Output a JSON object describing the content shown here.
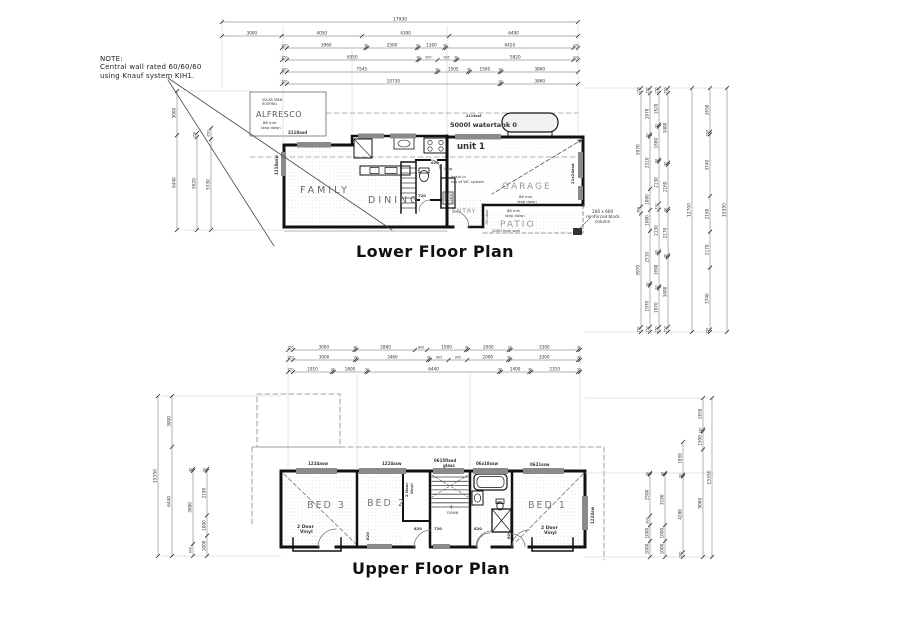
{
  "note": {
    "line1": "NOTE:",
    "line2": "Central wall rated 60/60/60",
    "line3": "using Knauf system KIH1."
  },
  "lower_plan": {
    "title": "Lower Floor Plan"
  },
  "upper_plan": {
    "title": "Upper Floor Plan"
  },
  "dims": {
    "top": [
      [
        "17930"
      ],
      [
        "3000",
        "4050",
        "4390",
        "6490"
      ],
      [
        "250",
        "3960",
        "90",
        "2500",
        "90",
        "1300",
        "90",
        "6420",
        "230"
      ],
      [
        "250",
        "6550",
        "90",
        "905",
        "905",
        "90",
        "5820",
        "230"
      ],
      [
        "250",
        "7545",
        "90",
        "1505",
        "90",
        "1500",
        "90",
        "3860"
      ],
      [
        "250",
        "10730",
        "90",
        "3860"
      ]
    ],
    "middle": [
      [
        "250",
        "3000",
        "90",
        "2860",
        "600",
        "1900",
        "90",
        "2000",
        "90",
        "3300",
        "90"
      ],
      [
        "250",
        "3000",
        "90",
        "3460",
        "90",
        "905",
        "905",
        "2000",
        "90",
        "3300",
        "90"
      ],
      [
        "250",
        "1910",
        "90",
        "1600",
        "90",
        "6440",
        "90",
        "1400",
        "90",
        "2310",
        "90"
      ]
    ],
    "lower_left": [
      [
        "3000",
        "6440"
      ],
      [
        "250",
        "5620"
      ],
      [
        "650",
        "5330"
      ]
    ],
    "lower_right": [
      [
        "250",
        "5970",
        "360",
        "5970",
        "250"
      ],
      [
        "250",
        "1970",
        "90",
        "2510",
        "1000",
        "1000",
        "2510",
        "90",
        "1970",
        "250"
      ],
      [
        "250",
        "1620",
        "90",
        "1690",
        "90",
        "2130",
        "310",
        "2130",
        "90",
        "1690",
        "90",
        "1970",
        "250"
      ],
      [
        "250",
        "3400",
        "90",
        "2160",
        "90",
        "2170",
        "90",
        "3400",
        "250"
      ],
      [
        "12700"
      ],
      [
        "2650",
        "150",
        "3740",
        "2160",
        "2170",
        "3740",
        "150"
      ],
      [
        "15350"
      ]
    ],
    "upper_left": [
      [
        "15350"
      ],
      [
        "3000",
        "6440"
      ],
      [
        "90",
        "3680",
        "600"
      ],
      [
        "90",
        "2190",
        "1000",
        "1000"
      ]
    ],
    "upper_right": [
      [
        "90",
        "2590",
        "600",
        "1000",
        "1000"
      ],
      [
        "90",
        "3190",
        "1000",
        "1000"
      ],
      [
        "1850",
        "90",
        "4280",
        "260"
      ],
      [
        "2650",
        "150",
        "1500",
        "9000"
      ],
      [
        "15350"
      ]
    ]
  },
  "labels": [
    {
      "t": "SOLAR SPAN",
      "x": 262,
      "y": 101,
      "s": 3.2,
      "n": "alfresco-roofing-note"
    },
    {
      "t": "ROOFING",
      "x": 262,
      "y": 105,
      "s": 3.2,
      "n": "alfresco-roofing-note"
    },
    {
      "t": "ALFRESCO",
      "x": 256,
      "y": 117,
      "s": 8,
      "c": "#555",
      "ls": 0.5,
      "n": "room-alfresco"
    },
    {
      "t": "86 mm",
      "x": 263,
      "y": 124,
      "s": 3.8,
      "n": "step-note"
    },
    {
      "t": "step down",
      "x": 261,
      "y": 129,
      "s": 3.8,
      "n": "step-note"
    },
    {
      "t": "2118asd",
      "x": 288,
      "y": 134,
      "s": 4,
      "w": "bold",
      "n": "window-label"
    },
    {
      "t": "1218asw",
      "x": 278,
      "y": 175,
      "s": 4,
      "w": "bold",
      "r": -90,
      "n": "window-label"
    },
    {
      "t": "2113asf",
      "x": 466,
      "y": 117,
      "s": 3.4,
      "w": "bold",
      "n": "window-label"
    },
    {
      "t": "5000l watertank 0",
      "x": 450,
      "y": 127,
      "s": 6.5,
      "w": "bold",
      "n": "watertank-label"
    },
    {
      "t": "unit 1",
      "x": 457,
      "y": 149,
      "s": 8.5,
      "w": "bold",
      "n": "unit-label"
    },
    {
      "t": "GARAGE",
      "x": 502,
      "y": 189,
      "s": 9,
      "c": "#999",
      "ls": 2,
      "n": "room-garage"
    },
    {
      "t": "86 mm",
      "x": 519,
      "y": 198,
      "s": 3.8,
      "n": "step-note"
    },
    {
      "t": "step down",
      "x": 517,
      "y": 203,
      "s": 3.8,
      "n": "step-note"
    },
    {
      "t": "21x24asd",
      "x": 574,
      "y": 184,
      "s": 3.8,
      "w": "bold",
      "r": -90,
      "n": "door-label"
    },
    {
      "t": "lndg",
      "x": 444,
      "y": 170,
      "s": 3.8,
      "n": "landing-note"
    },
    {
      "t": "basin in",
      "x": 451,
      "y": 178,
      "s": 3.8,
      "n": "wc-note"
    },
    {
      "t": "top of WC system",
      "x": 451,
      "y": 183,
      "s": 3.8,
      "n": "wc-note"
    },
    {
      "t": "FAMILY",
      "x": 300,
      "y": 193,
      "s": 9.5,
      "c": "#666",
      "ls": 3,
      "n": "room-family"
    },
    {
      "t": "DINING",
      "x": 368,
      "y": 203,
      "s": 9.5,
      "c": "#666",
      "ls": 3,
      "n": "room-dining"
    },
    {
      "t": "720",
      "x": 418,
      "y": 197,
      "s": 3.8,
      "w": "bold",
      "n": "door-label"
    },
    {
      "t": "820",
      "x": 431,
      "y": 164,
      "s": 3.8,
      "w": "bold",
      "n": "door-label"
    },
    {
      "t": "820",
      "x": 447,
      "y": 201,
      "s": 3.8,
      "w": "bold",
      "r": -90,
      "n": "door-label"
    },
    {
      "t": "LNDY",
      "x": 452,
      "y": 203,
      "s": 3.8,
      "r": -90,
      "n": "room-laundry"
    },
    {
      "t": "ENTRY",
      "x": 452,
      "y": 213,
      "s": 6,
      "c": "#888",
      "ls": 1,
      "n": "room-entry"
    },
    {
      "t": "PATIO",
      "x": 500,
      "y": 227,
      "s": 9,
      "c": "#999",
      "ls": 2,
      "n": "room-patio"
    },
    {
      "t": "86 mm",
      "x": 507,
      "y": 212,
      "s": 3.8,
      "n": "step-note"
    },
    {
      "t": "step down",
      "x": 505,
      "y": 217,
      "s": 3.8,
      "n": "step-note"
    },
    {
      "t": "2000 high wall",
      "x": 492,
      "y": 232,
      "s": 3.8,
      "n": "wall-note"
    },
    {
      "t": "720 door",
      "x": 488,
      "y": 225,
      "s": 3.4,
      "r": -90,
      "n": "door-label"
    },
    {
      "t": "200 x 600",
      "x": 592,
      "y": 213,
      "s": 4.2,
      "n": "column-note"
    },
    {
      "t": "reinforced block",
      "x": 586,
      "y": 218,
      "s": 4.2,
      "n": "column-note"
    },
    {
      "t": "column",
      "x": 595,
      "y": 223,
      "s": 4.2,
      "n": "column-note"
    },
    {
      "t": "BED 3",
      "x": 307,
      "y": 508,
      "s": 9.5,
      "c": "#777",
      "ls": 2,
      "n": "room-bed3"
    },
    {
      "t": "BED 2",
      "x": 367,
      "y": 506,
      "s": 9.5,
      "c": "#777",
      "ls": 2,
      "n": "room-bed2"
    },
    {
      "t": "BED 1",
      "x": 528,
      "y": 508,
      "s": 9.5,
      "c": "#777",
      "ls": 2,
      "n": "room-bed1"
    },
    {
      "t": "2 Door",
      "x": 297,
      "y": 528,
      "s": 4.5,
      "w": "bold",
      "n": "robe-label"
    },
    {
      "t": "Vinyl",
      "x": 300,
      "y": 533,
      "s": 4.5,
      "w": "bold",
      "n": "robe-label"
    },
    {
      "t": "2 Door",
      "x": 541,
      "y": 529,
      "s": 4.5,
      "w": "bold",
      "n": "robe-label"
    },
    {
      "t": "Vinyl",
      "x": 544,
      "y": 534,
      "s": 4.5,
      "w": "bold",
      "n": "robe-label"
    },
    {
      "t": "2 Door",
      "x": 408,
      "y": 497,
      "s": 3.8,
      "w": "bold",
      "r": -90,
      "n": "robe-label"
    },
    {
      "t": "Vinyl",
      "x": 413,
      "y": 494,
      "s": 3.8,
      "w": "bold",
      "r": -90,
      "n": "robe-label"
    },
    {
      "t": "DOWN",
      "x": 447,
      "y": 514,
      "s": 3.4,
      "n": "stair-down-label"
    },
    {
      "t": "↑",
      "x": 449,
      "y": 509,
      "s": 5,
      "n": "stair-arrow"
    },
    {
      "t": "900",
      "x": 496,
      "y": 503,
      "s": 3,
      "n": "dim-note"
    },
    {
      "t": "820",
      "x": 414,
      "y": 530,
      "s": 3.8,
      "w": "bold",
      "n": "door-label"
    },
    {
      "t": "720",
      "x": 434,
      "y": 530,
      "s": 3.8,
      "w": "bold",
      "n": "door-label"
    },
    {
      "t": "820",
      "x": 474,
      "y": 530,
      "s": 3.8,
      "w": "bold",
      "n": "door-label"
    },
    {
      "t": "820",
      "x": 510,
      "y": 539,
      "s": 3.8,
      "w": "bold",
      "r": -90,
      "n": "door-label"
    },
    {
      "t": "820",
      "x": 369,
      "y": 540,
      "s": 3.8,
      "w": "bold",
      "r": -90,
      "n": "door-label"
    },
    {
      "t": "1224asw",
      "x": 308,
      "y": 465,
      "s": 4,
      "w": "bold",
      "n": "window-label"
    },
    {
      "t": "1224ssw",
      "x": 382,
      "y": 465,
      "s": 4,
      "w": "bold",
      "n": "window-label"
    },
    {
      "t": "0615fixed",
      "x": 434,
      "y": 462,
      "s": 4,
      "w": "bold",
      "n": "window-label"
    },
    {
      "t": "glass",
      "x": 443,
      "y": 467,
      "s": 4,
      "w": "bold",
      "n": "window-label"
    },
    {
      "t": "06x18ssw",
      "x": 476,
      "y": 465,
      "s": 4,
      "w": "bold",
      "n": "window-label"
    },
    {
      "t": "0621ssw",
      "x": 530,
      "y": 466,
      "s": 4,
      "w": "bold",
      "n": "window-label"
    },
    {
      "t": "1224sw",
      "x": 594,
      "y": 524,
      "s": 4,
      "w": "bold",
      "r": -90,
      "n": "window-label"
    }
  ]
}
